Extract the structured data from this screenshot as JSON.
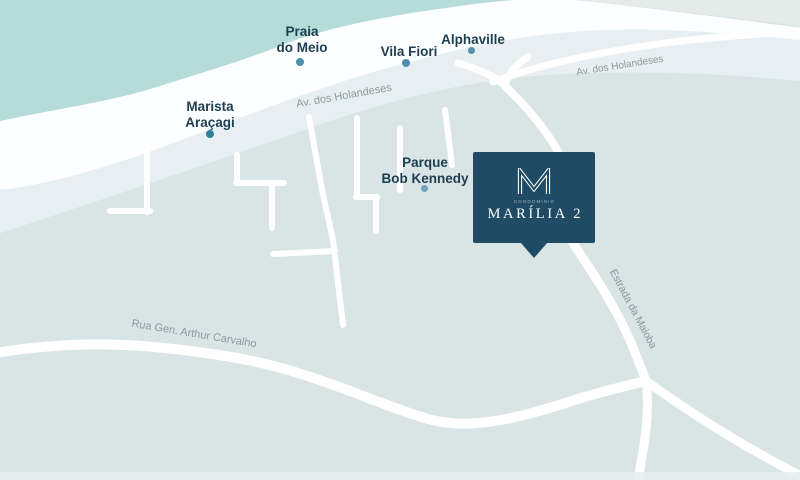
{
  "map": {
    "places": [
      {
        "label": "Praia do Meio",
        "line1": "Praia",
        "line2": "do Meio",
        "dot_color": "#4e8fae"
      },
      {
        "label": "Vila Fiori",
        "line1": "Vila Fiori",
        "line2": "",
        "dot_color": "#4e8fae"
      },
      {
        "label": "Alphaville",
        "line1": "Alphaville",
        "line2": "",
        "dot_color": "#548fab"
      },
      {
        "label": "Marista Araçagi",
        "line1": "Marista",
        "line2": "Araçagi",
        "dot_color": "#2f7f9b"
      },
      {
        "label": "Parque Bob Kennedy",
        "line1": "Parque",
        "line2": "Bob Kennedy",
        "dot_color": "#74a4b8"
      }
    ],
    "roads": [
      {
        "label": "Av. dos Holandeses"
      },
      {
        "label": "Av. dos Holandeses"
      },
      {
        "label": "Estrada da Maioba"
      },
      {
        "label": "Rua Gen. Arthur Carvalho"
      }
    ],
    "marker": {
      "brand": "CONDOMÍNIO",
      "name": "MARÍLIA 2",
      "logo": "m-monogram-icon",
      "background": "#1f4c64",
      "text_color": "#fdfeff"
    },
    "colors": {
      "ocean": "#b5dcd8",
      "beach": "#fcfeff",
      "avenue_band": "#e8eff2",
      "land": "#d9e4e5",
      "corner_patch": "#e4ebe9",
      "road": "#ffffff",
      "place_label": "#1d3e50",
      "road_label": "#8d99a1"
    }
  }
}
